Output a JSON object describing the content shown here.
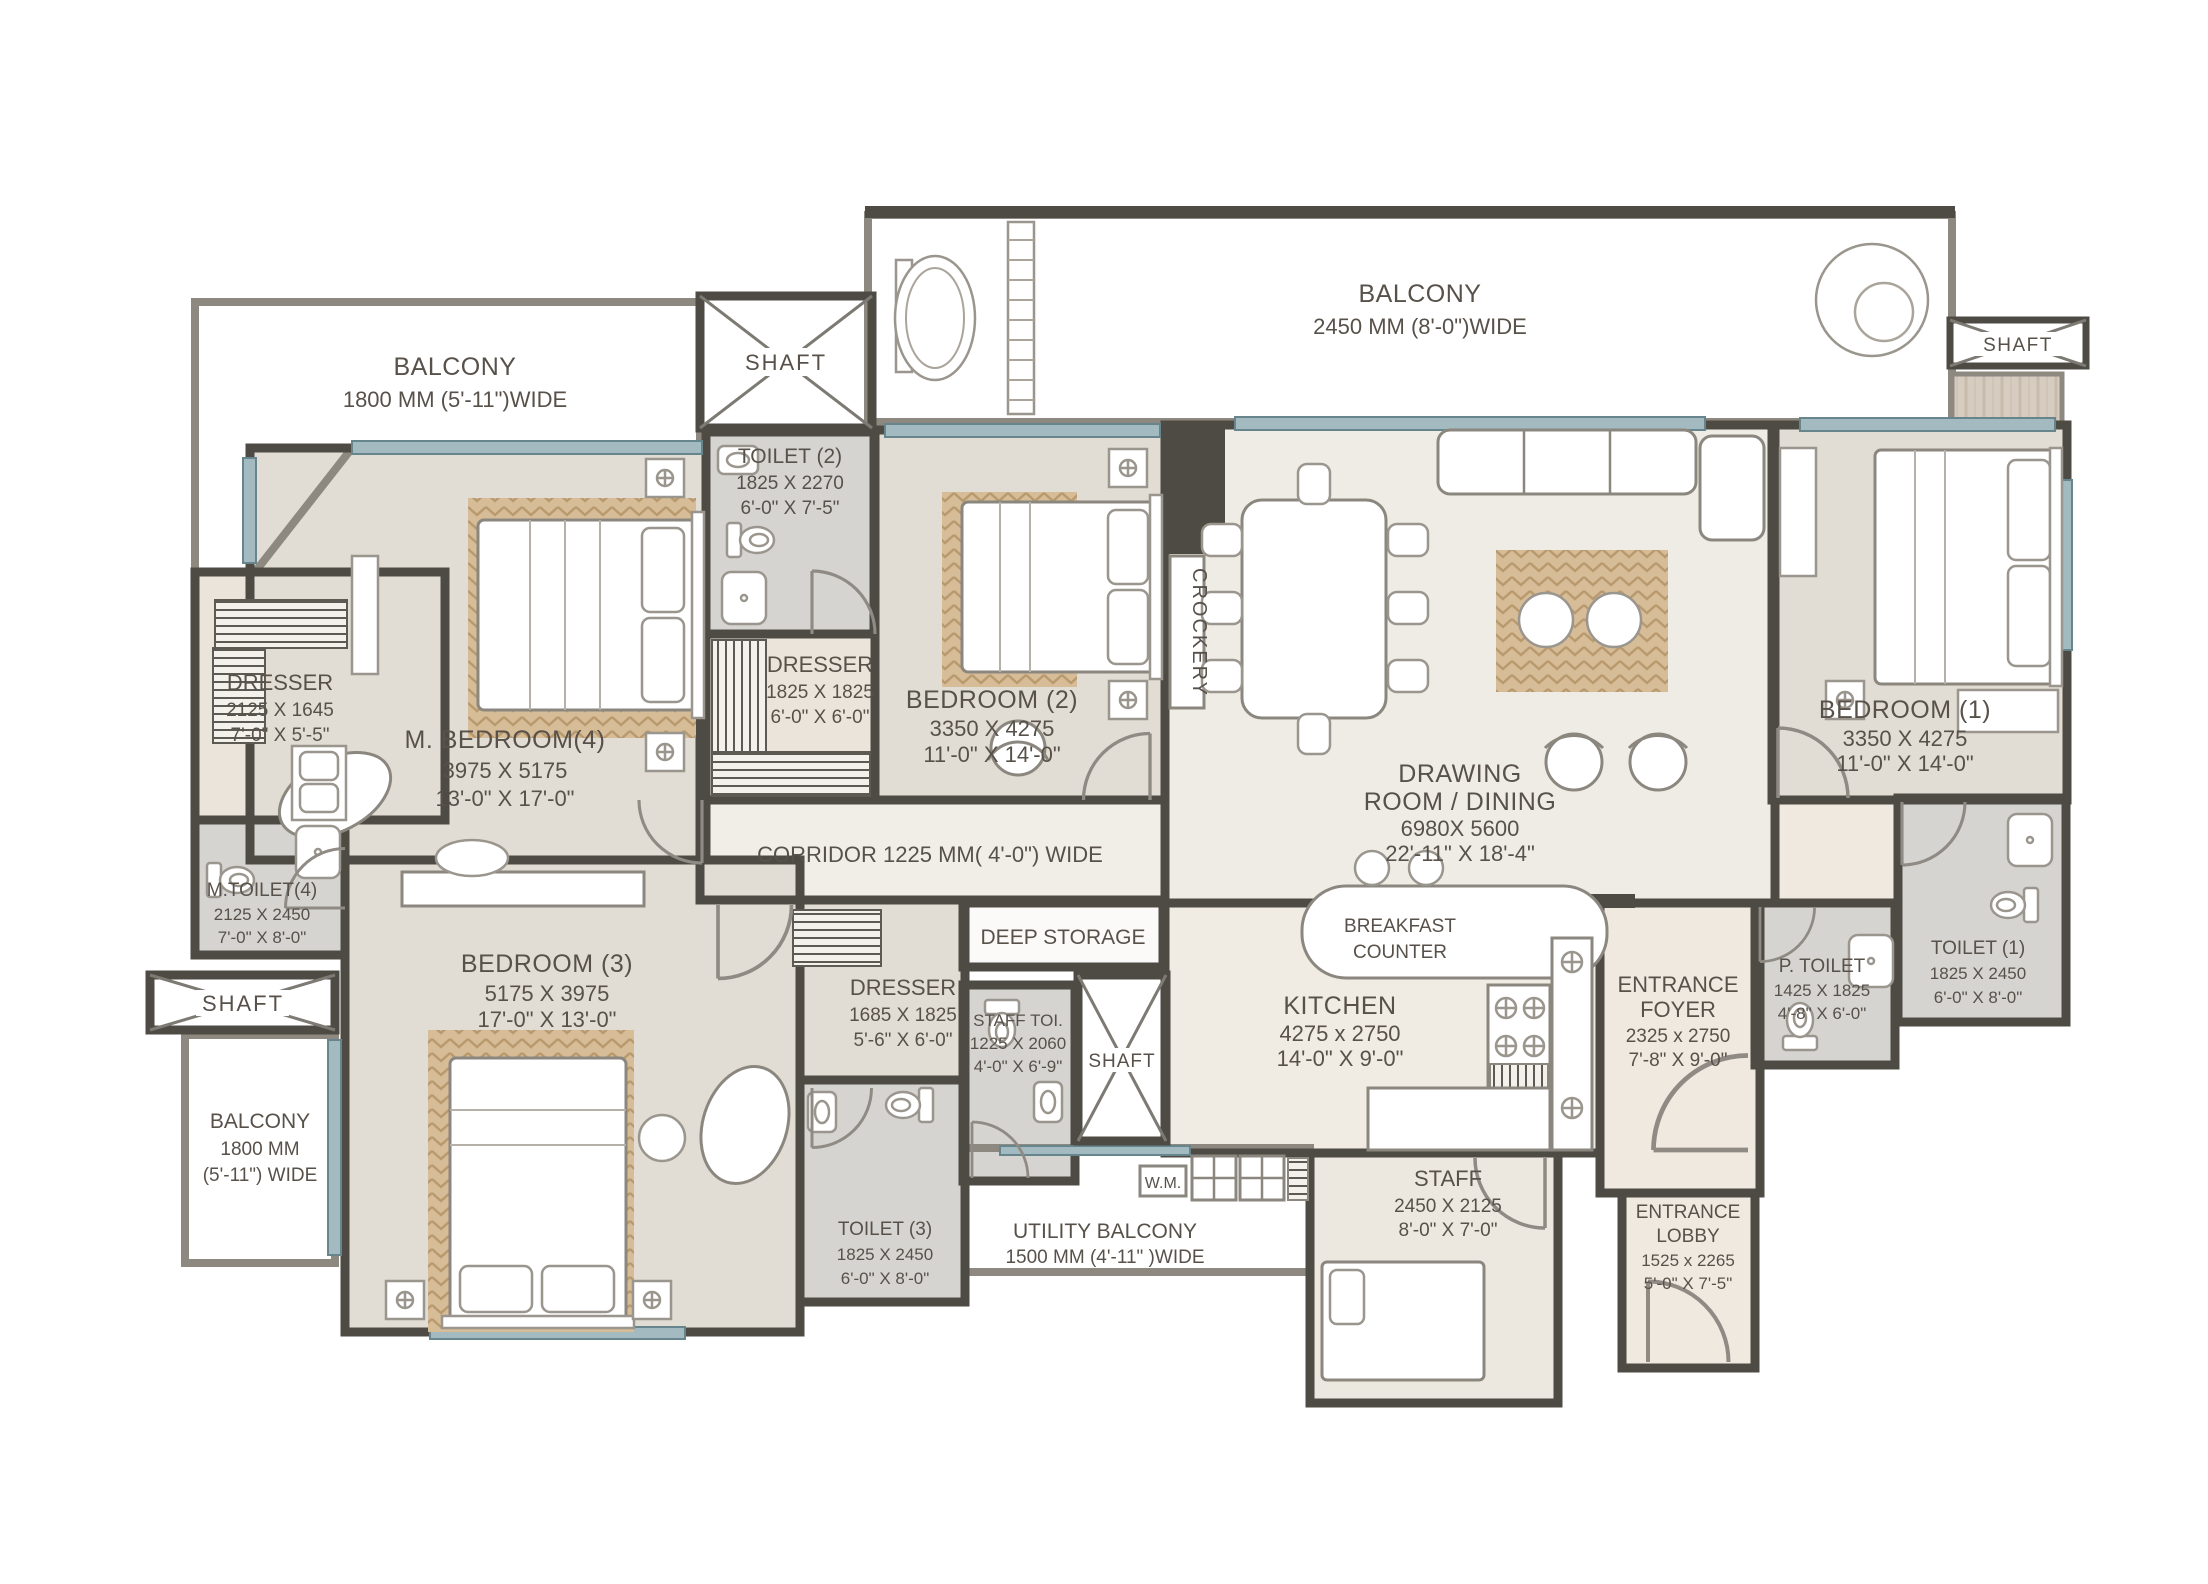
{
  "palette": {
    "wall": "#4e4b45",
    "balcony_wall": "#8d8880",
    "floor": "#eae6df",
    "bedroom_floor": "#e2ddd4",
    "toilet_floor": "#d5d4d1",
    "wood": "#d7ccc0",
    "rug": "#d6bc97",
    "window": "#a3bac0",
    "label": "#57514a"
  },
  "rooms": {
    "balcony_top_left": {
      "name": "BALCONY",
      "dim_mm": "1800 MM (5'-11\")WIDE"
    },
    "shaft_top_left": {
      "name": "SHAFT"
    },
    "balcony_top": {
      "name": "BALCONY",
      "dim_mm": "2450 MM (8'-0\")WIDE"
    },
    "shaft_top_right": {
      "name": "SHAFT"
    },
    "toilet_2": {
      "name": "TOILET (2)",
      "dim_mm": "1825 X 2270",
      "dim_ft": "6'-0\" X 7'-5\""
    },
    "dresser_master": {
      "name": "DRESSER",
      "dim_mm": "2125 X 1645",
      "dim_ft": "7'-0\" X 5'-5\""
    },
    "master_bedroom": {
      "name": "M. BEDROOM(4)",
      "dim_mm": "3975 X 5175",
      "dim_ft": "13'-0\" X 17'-0\""
    },
    "dresser_2": {
      "name": "DRESSER",
      "dim_mm": "1825 X 1825",
      "dim_ft": "6'-0\" X 6'-0\""
    },
    "bedroom_2": {
      "name": "BEDROOM (2)",
      "dim_mm": "3350 X 4275",
      "dim_ft": "11'-0\" X 14'-0\""
    },
    "crockery": {
      "name": "CROCKERY"
    },
    "drawing_dining": {
      "name_1": "DRAWING",
      "name_2": "ROOM / DINING",
      "dim_mm": "6980X 5600",
      "dim_ft": "22'-11\" X 18'-4\""
    },
    "bedroom_1": {
      "name": "BEDROOM (1)",
      "dim_mm": "3350 X 4275",
      "dim_ft": "11'-0\" X 14'-0\""
    },
    "corridor": {
      "name": "CORRIDOR 1225 MM( 4'-0\") WIDE"
    },
    "m_toilet": {
      "name": "M.TOILET(4)",
      "dim_mm": "2125 X 2450",
      "dim_ft": "7'-0\" X 8'-0\""
    },
    "shaft_left": {
      "name": "SHAFT"
    },
    "balcony_bottom_left": {
      "name": "BALCONY",
      "dim_mm": "1800 MM",
      "dim_ft": "(5'-11\") WIDE"
    },
    "bedroom_3": {
      "name": "BEDROOM (3)",
      "dim_mm": "5175 X 3975",
      "dim_ft": "17'-0\" X 13'-0\""
    },
    "dresser_3": {
      "name": "DRESSER",
      "dim_mm": "1685 X 1825",
      "dim_ft": "5'-6\" X 6'-0\""
    },
    "deep_storage": {
      "name": "DEEP STORAGE"
    },
    "staff_toilet": {
      "name": "STAFF TOI.",
      "dim_mm": "1225 X 2060",
      "dim_ft": "4'-0\" X 6'-9\""
    },
    "shaft_center": {
      "name": "SHAFT"
    },
    "washing_machine": {
      "name": "W.M."
    },
    "utility_balcony": {
      "name": "UTILITY BALCONY",
      "dim_mm": "1500 MM (4'-11\" )WIDE"
    },
    "toilet_3": {
      "name": "TOILET (3)",
      "dim_mm": "1825 X 2450",
      "dim_ft": "6'-0\" X 8'-0\""
    },
    "kitchen": {
      "name": "KITCHEN",
      "dim_mm": "4275 x 2750",
      "dim_ft": "14'-0\" X 9'-0\""
    },
    "breakfast_counter": {
      "name_1": "BREAKFAST",
      "name_2": "COUNTER"
    },
    "entrance_foyer": {
      "name_1": "ENTRANCE",
      "name_2": "FOYER",
      "dim_mm": "2325 x 2750",
      "dim_ft": "7'-8\" X 9'-0\""
    },
    "staff_room": {
      "name": "STAFF",
      "dim_mm": "2450 X 2125",
      "dim_ft": "8'-0\" X 7'-0\""
    },
    "entrance_lobby": {
      "name_1": "ENTRANCE",
      "name_2": "LOBBY",
      "dim_mm": "1525 x 2265",
      "dim_ft": "5'-0\" X 7'-5\""
    },
    "p_toilet": {
      "name": "P. TOILET",
      "dim_mm": "1425 X 1825",
      "dim_ft": "4'-8\" X 6'-0\""
    },
    "toilet_1": {
      "name": "TOILET (1)",
      "dim_mm": "1825 X 2450",
      "dim_ft": "6'-0\" X 8'-0\""
    }
  }
}
